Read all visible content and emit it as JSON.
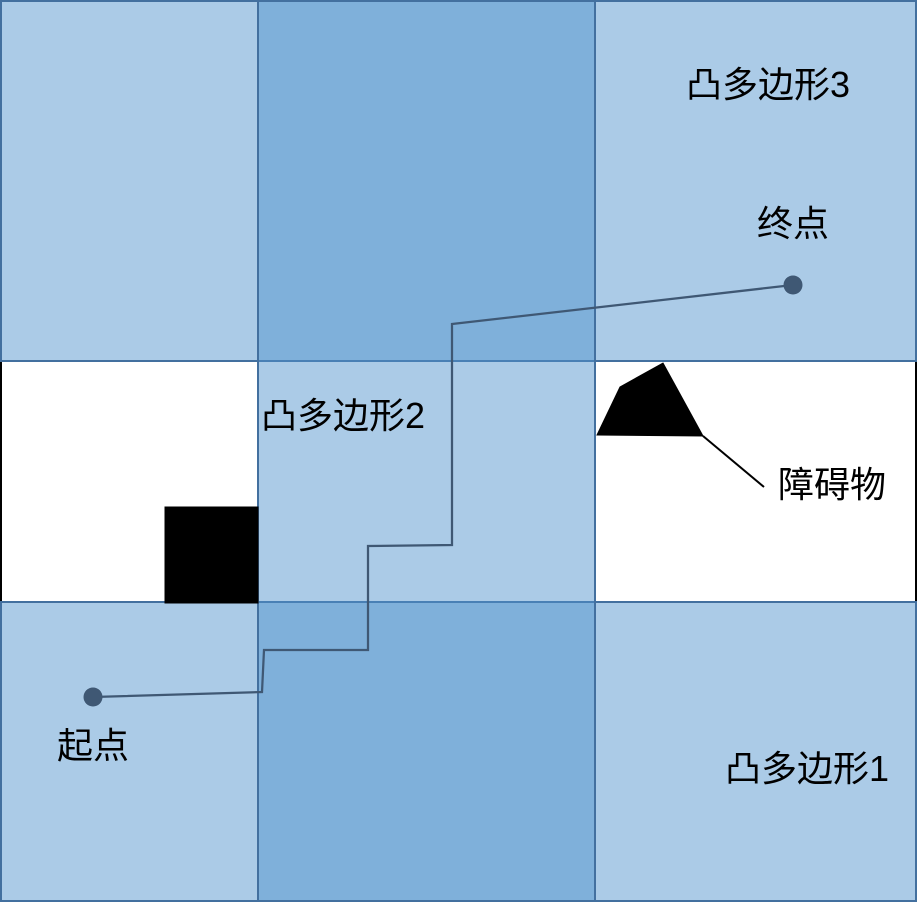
{
  "labels": {
    "polygon3": "凸多边形3",
    "polygon2": "凸多边形2",
    "polygon1": "凸多边形1",
    "start": "起点",
    "end": "终点",
    "obstacle": "障碍物"
  },
  "colors": {
    "polygon-fill": "rgba(79, 146, 205, 0.48)",
    "polygon-border": "#43709f",
    "path": "#3f5874",
    "obstacle": "#000000",
    "frame": "#000000",
    "text": "#000000",
    "background": "#ffffff"
  }
}
